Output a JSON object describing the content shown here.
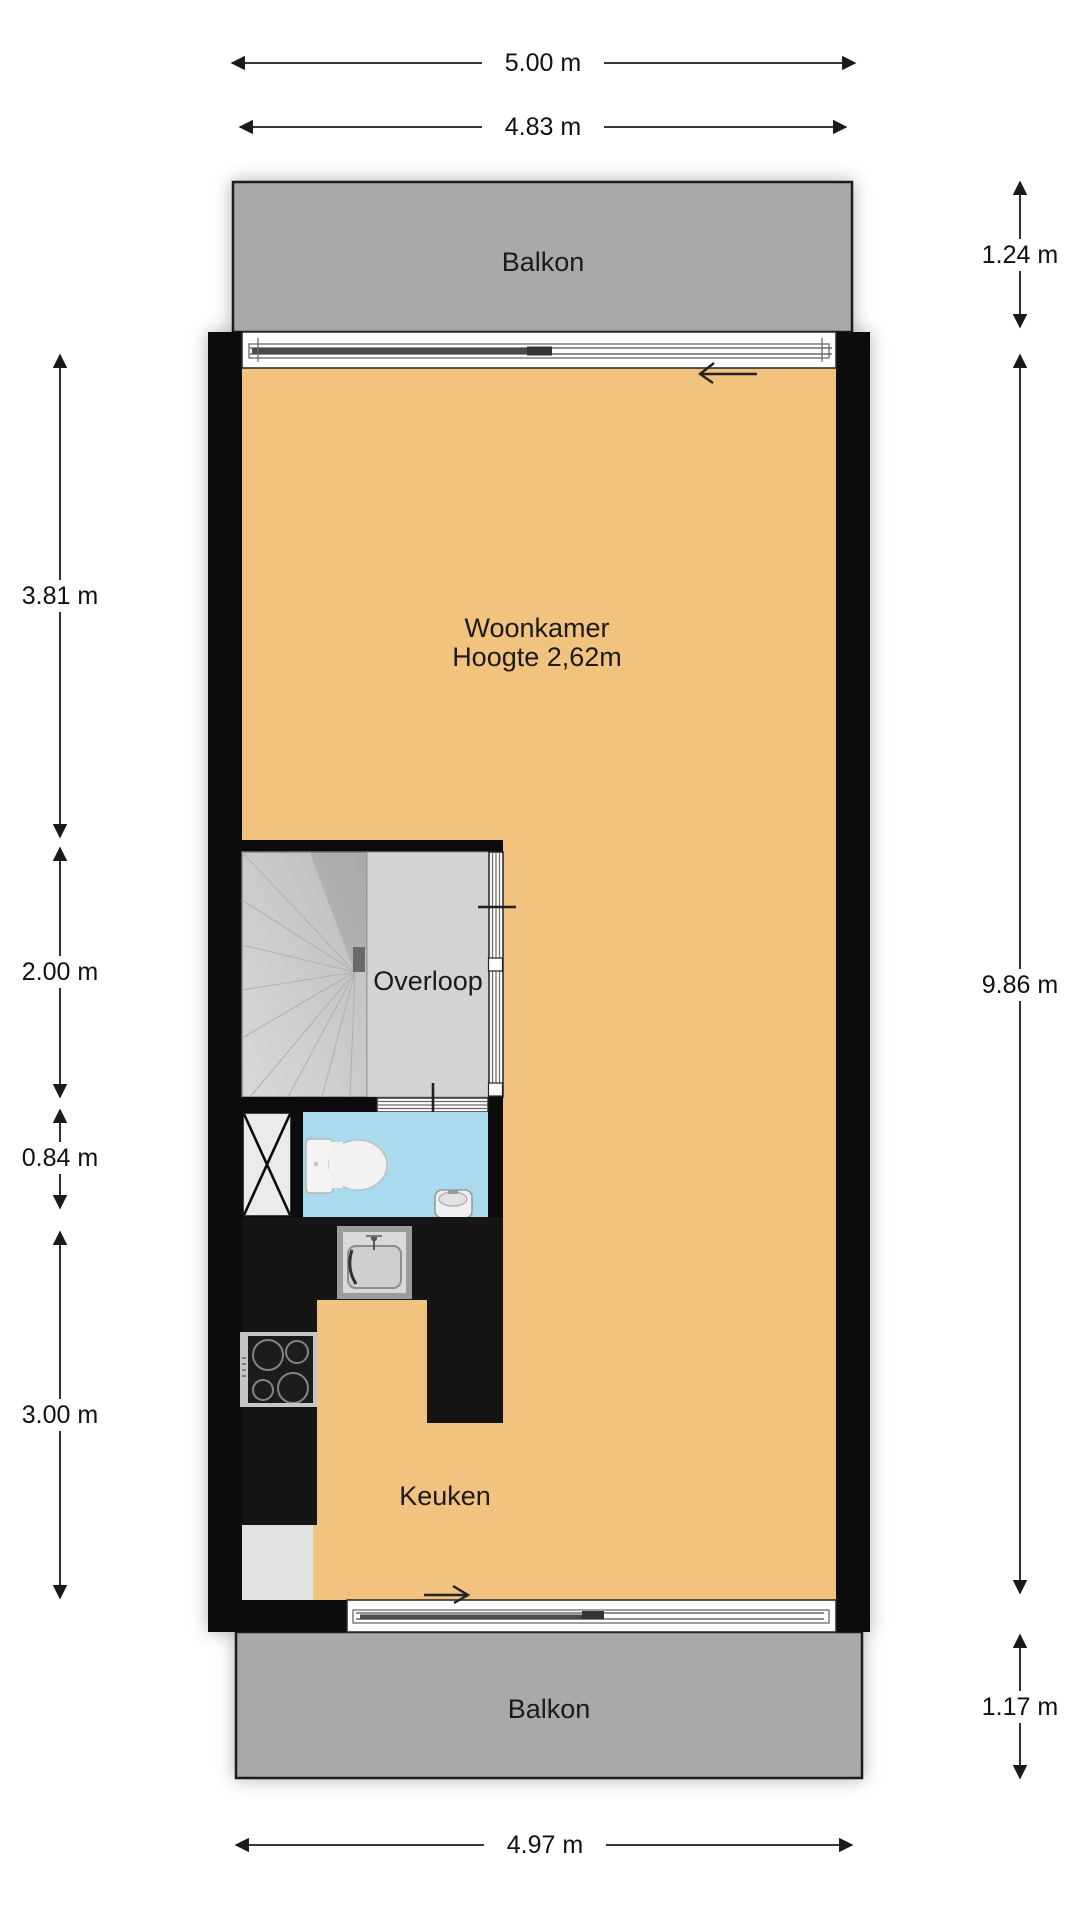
{
  "floorplan": {
    "labels": {
      "balcony_top": "Balkon",
      "balcony_bottom": "Balkon",
      "living_room": "Woonkamer",
      "living_room_height": "Hoogte 2,62m",
      "landing": "Overloop",
      "kitchen": "Keuken"
    },
    "dimensions": {
      "top_outer": "5.00 m",
      "top_inner": "4.83 m",
      "left_living": "3.81 m",
      "left_landing": "2.00 m",
      "left_toilet": "0.84 m",
      "left_kitchen": "3.00 m",
      "right_balcony_top": "1.24 m",
      "right_total": "9.86 m",
      "right_balcony_bottom": "1.17 m",
      "bottom": "4.97 m"
    },
    "colors": {
      "floor": "#f2c27f",
      "balcony": "#a9a9a9",
      "wet_room": "#a9daee",
      "stairs_dark": "#c3c3c3",
      "landing_floor": "#d4d4d4",
      "shaft": "#ebebeb",
      "counter": "#151515",
      "appliance_block": "#e3e3e3"
    }
  }
}
